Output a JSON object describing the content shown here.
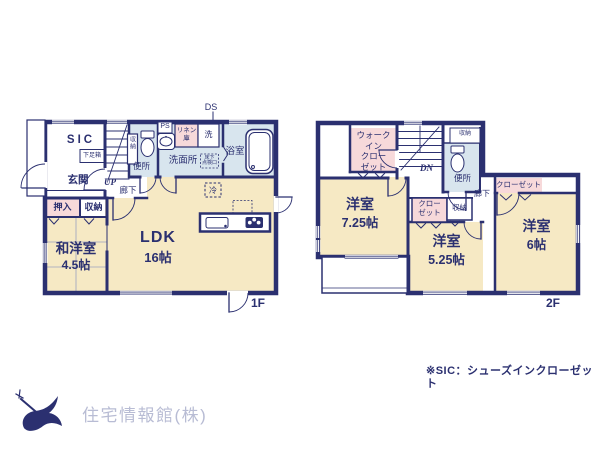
{
  "colors": {
    "wall_navy": "#2b3070",
    "room_cream": "#f6e9c4",
    "closet_pink": "#f7d9da",
    "wet_area_blue": "#d8e5ee",
    "logo_text_gray": "#b8bcd4"
  },
  "floor1": {
    "label": "1F",
    "ds": "DS",
    "sic": "SIC",
    "shoe_box": "下足箱",
    "entrance": "玄関",
    "up": "UP",
    "hallway": "廊下",
    "stair_storage": "収納",
    "toilet": "便所",
    "ps": "PS",
    "linen": "リネン\n庫",
    "washer": "洗",
    "washroom": "洗面所",
    "bathroom": "浴室",
    "fridge": "冷",
    "floor_hatch": "床下\n点検口",
    "ldk": {
      "name": "LDK",
      "size": "16帖"
    },
    "oshiire": "押入",
    "storage": "収納",
    "tatami_room": {
      "name": "和洋室",
      "size": "4.5帖"
    }
  },
  "floor2": {
    "label": "2F",
    "wic": "ウォーク\nイン\nクロー\nゼット",
    "dn": "DN",
    "storage_top": "収納",
    "toilet": "便所",
    "hallway": "廊下",
    "closet_right": "クローゼット",
    "closet_mid": "クロー\nゼット",
    "storage_mid": "収納",
    "room_725": {
      "name": "洋室",
      "size": "7.25帖"
    },
    "room_525": {
      "name": "洋室",
      "size": "5.25帖"
    },
    "room_6": {
      "name": "洋室",
      "size": "6帖"
    }
  },
  "footer": {
    "note": "※SIC：シューズインクローゼット",
    "company": "住宅情報館(株)"
  }
}
